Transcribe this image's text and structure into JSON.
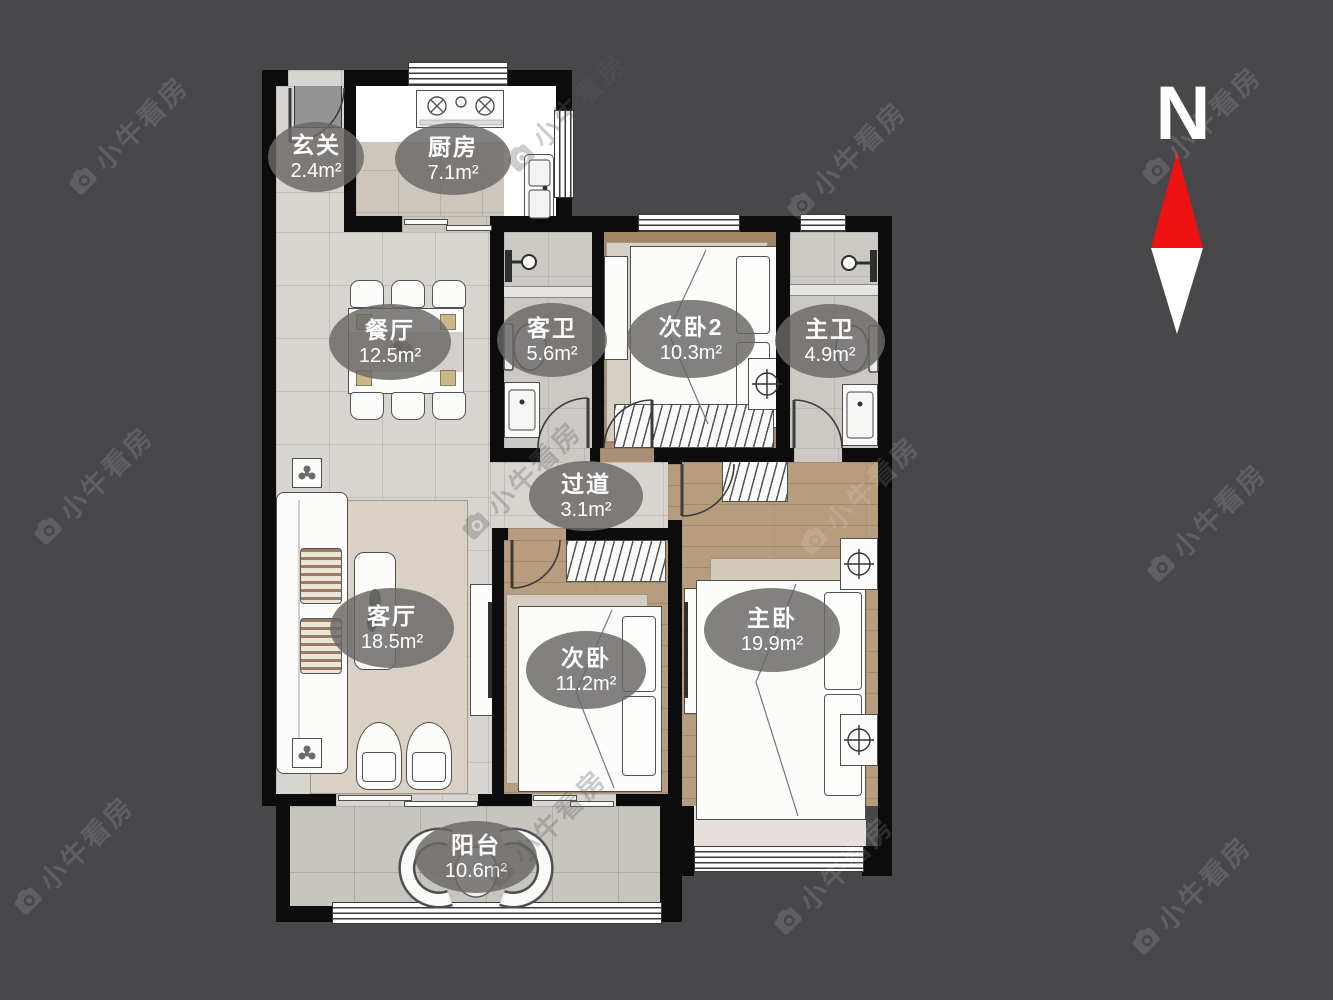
{
  "watermark": {
    "brand": "小牛看房"
  },
  "compass": {
    "north_label": "N"
  },
  "rooms": [
    {
      "key": "entry",
      "name": "玄关",
      "area": "2.4m²"
    },
    {
      "key": "kitchen",
      "name": "厨房",
      "area": "7.1m²"
    },
    {
      "key": "dining",
      "name": "餐厅",
      "area": "12.5m²"
    },
    {
      "key": "guest-bath",
      "name": "客卫",
      "area": "5.6m²"
    },
    {
      "key": "bedroom2",
      "name": "次卧2",
      "area": "10.3m²"
    },
    {
      "key": "master-bath",
      "name": "主卫",
      "area": "4.9m²"
    },
    {
      "key": "hallway",
      "name": "过道",
      "area": "3.1m²"
    },
    {
      "key": "living",
      "name": "客厅",
      "area": "18.5m²"
    },
    {
      "key": "bedroom",
      "name": "次卧",
      "area": "11.2m²"
    },
    {
      "key": "master-bedroom",
      "name": "主卧",
      "area": "19.9m²"
    },
    {
      "key": "balcony",
      "name": "阳台",
      "area": "10.6m²"
    }
  ],
  "colors": {
    "background": "#48474a",
    "wall": "#0c0c0c",
    "compass_red": "#ee1111",
    "label_pill": "#6a6866"
  }
}
